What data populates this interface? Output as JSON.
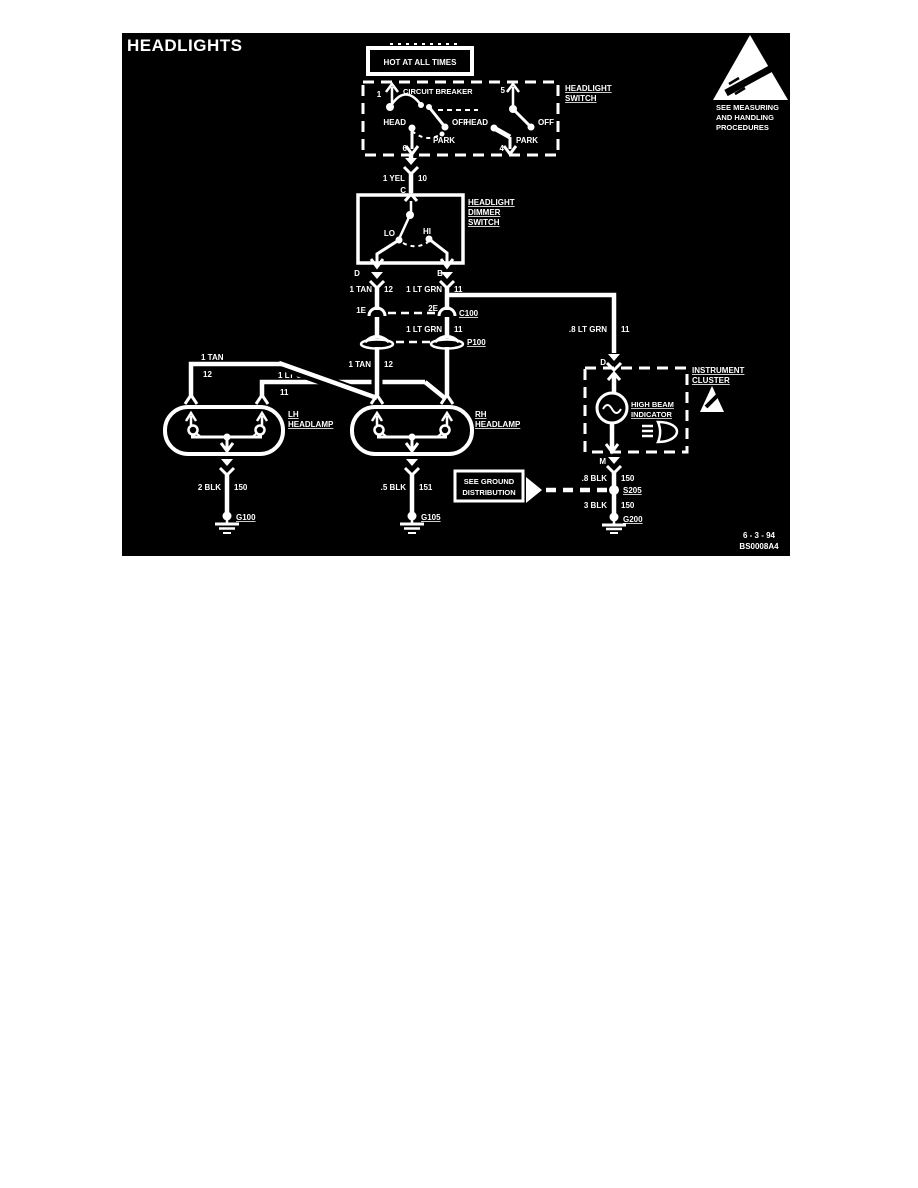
{
  "title": "HEADLIGHTS",
  "power": {
    "hot_label": "HOT AT ALL TIMES"
  },
  "esd_warning": {
    "line1": "SEE MEASURING",
    "line2": "AND HANDLING",
    "line3": "PROCEDURES"
  },
  "headlight_switch": {
    "label_line1": "HEADLIGHT",
    "label_line2": "SWITCH",
    "circuit_breaker": "CIRCUIT BREAKER",
    "terminal_1": "1",
    "terminal_5": "5",
    "terminal_6": "6",
    "terminal_4": "4",
    "left_head": "HEAD",
    "left_off": "OFF",
    "left_park": "PARK",
    "right_head": "HEAD",
    "right_off": "OFF",
    "right_park": "PARK"
  },
  "dimmer_switch": {
    "label_line1": "HEADLIGHT",
    "label_line2": "DIMMER",
    "label_line3": "SWITCH",
    "terminal_c": "C",
    "terminal_d": "D",
    "terminal_b": "B",
    "lo": "LO",
    "hi": "HI"
  },
  "wires": {
    "yel": {
      "name": "1 YEL",
      "circuit": "10"
    },
    "tan_upper": {
      "name": "1 TAN",
      "circuit": "12"
    },
    "ltgrn_upper": {
      "name": "1 LT GRN",
      "circuit": "11"
    },
    "ltgrn_mid": {
      "name": "1 LT GRN",
      "circuit": "11"
    },
    "tan_lower": {
      "name": "1 TAN",
      "circuit": "12"
    },
    "tan_branch": {
      "name": "1 TAN",
      "circuit": "12"
    },
    "ltgrn_branch": {
      "name": "1 LT GRN",
      "circuit": "11"
    },
    "ltgrn_indicator": {
      "name": ".8 LT GRN",
      "circuit": "11"
    },
    "blk_lh": {
      "name": "2 BLK",
      "circuit": "150"
    },
    "blk_rh": {
      "name": ".5 BLK",
      "circuit": "151"
    },
    "blk_indicator": {
      "name": ".8 BLK",
      "circuit": "150"
    },
    "blk_ground": {
      "name": "3 BLK",
      "circuit": "150"
    }
  },
  "connectors": {
    "c100": {
      "label": "C100",
      "terminal_left": "1E",
      "terminal_right": "2E"
    },
    "p100": {
      "label": "P100"
    },
    "s205": {
      "label": "S205"
    }
  },
  "grounds": {
    "g100": "G100",
    "g105": "G105",
    "g200": "G200"
  },
  "lamps": {
    "lh_line1": "LH",
    "lh_line2": "HEADLAMP",
    "rh_line1": "RH",
    "rh_line2": "HEADLAMP"
  },
  "cluster": {
    "label_line1": "INSTRUMENT",
    "label_line2": "CLUSTER",
    "indicator_line1": "HIGH BEAM",
    "indicator_line2": "INDICATOR",
    "terminal_d": "D",
    "terminal_m": "M"
  },
  "ground_note": {
    "line1": "SEE GROUND",
    "line2": "DISTRIBUTION"
  },
  "footer": {
    "date": "6 - 3 - 94",
    "code": "BS0008A4"
  },
  "colors": {
    "background": "#000000",
    "foreground": "#ffffff",
    "page": "#ffffff"
  }
}
